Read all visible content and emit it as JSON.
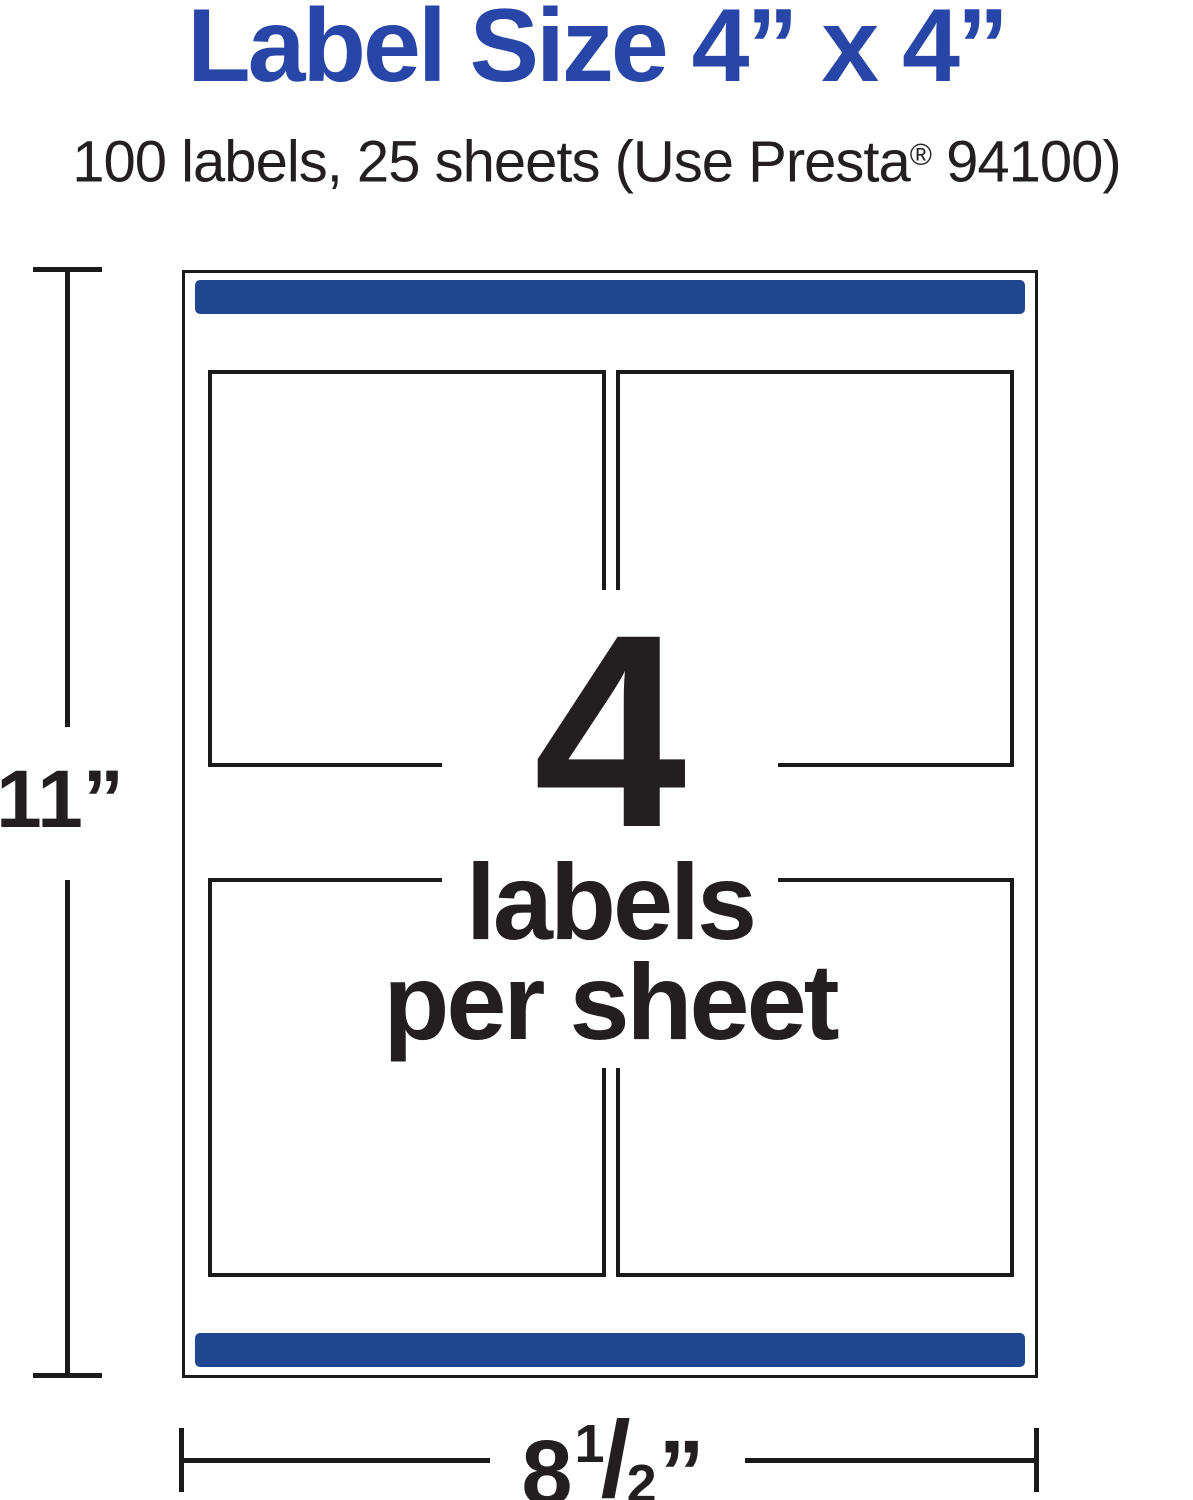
{
  "header": {
    "title": "Label Size 4” x 4”",
    "subtitle_pre": "100 labels, 25 sheets (Use Presta",
    "subtitle_reg": "®",
    "subtitle_post": " 94100)"
  },
  "sheet": {
    "count": "4",
    "labels_word": "labels",
    "per_sheet_word": "per sheet",
    "labels_per_sheet": 4,
    "cells": [
      "top-left",
      "top-right",
      "bottom-left",
      "bottom-right"
    ]
  },
  "dimensions": {
    "height_label": "11”",
    "width_whole": "8",
    "width_numerator": "1",
    "width_slash": "/",
    "width_denominator": "2",
    "width_unit": "”"
  },
  "colors": {
    "title_blue": "#2746a8",
    "bar_blue": "#1e4691",
    "ink": "#231f20"
  }
}
